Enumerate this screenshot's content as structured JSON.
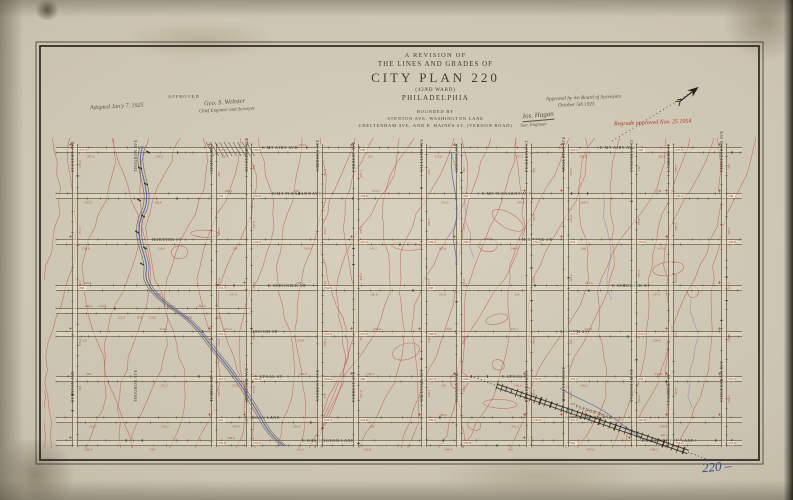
{
  "document": {
    "title": {
      "line1": "A REVISION OF",
      "line2": "THE LINES AND GRADES OF",
      "line3": "CITY PLAN 220",
      "line4": "(42ND WARD)",
      "line5": "PHILADELPHIA",
      "sub1": "BOUNDED BY",
      "sub2": "STENTON AVE. WASHINGTON LANE",
      "sub3": "CHELTENHAM AVE. AND E. HAINES ST. (VERNON ROAD)"
    },
    "annotations": {
      "adopted_note": "Adopted Jan'y 7. 1925",
      "approved_label": "APPROVED",
      "approval_signature": "Geo. S. Webster",
      "approval_title": "Chief Engineer and Surveyor",
      "board_note_line1": "Approved by the Board of Surveyors",
      "board_note_line2": "October 5th 1925",
      "second_signature": "Jos. Hagan",
      "second_signature_title": "Asst. Engineer",
      "regrade_note": "Regrade approved Nov. 25 1954",
      "plan_number_note": "220 –"
    }
  },
  "map": {
    "border": {
      "outer": [
        36,
        42,
        727,
        422
      ],
      "inner": [
        40,
        46,
        719,
        414
      ]
    },
    "grid_extent": {
      "x1": 56,
      "x2": 742,
      "y1": 144,
      "y2": 447
    },
    "horizontal_streets": [
      {
        "y": 150,
        "name": "E MT AIRY AVE",
        "label_xs": [
          262,
          600
        ]
      },
      {
        "y": 196,
        "name": "E MT PLEASANT AVE",
        "label_xs": [
          272,
          482
        ]
      },
      {
        "y": 242,
        "name": "HORTTER ST",
        "label_xs": [
          152,
          522
        ]
      },
      {
        "y": 288,
        "name": "E SEDGWICK ST",
        "label_xs": [
          268,
          612
        ]
      },
      {
        "y": 334,
        "name": "SLOCUM ST",
        "label_xs": [
          250,
          560
        ]
      },
      {
        "y": 379,
        "name": "E UPSAL ST",
        "label_xs": [
          255,
          502
        ]
      },
      {
        "y": 420,
        "name": "GORGAS LANE",
        "label_xs": [
          245,
          565
        ]
      },
      {
        "y": 443,
        "name": "E WASHINGTON LANE",
        "label_xs": [
          302,
          642
        ]
      }
    ],
    "partial_streets": [
      {
        "y": 311,
        "x1": 56,
        "x2": 252
      }
    ],
    "vertical_streets": [
      {
        "x": 75,
        "name": "STENTON AVE"
      },
      {
        "x": 214,
        "name": "TEMPLE RD"
      },
      {
        "x": 249,
        "name": "MICHENER AVE"
      },
      {
        "x": 320,
        "name": "ANDREWS AVE"
      },
      {
        "x": 356,
        "name": "FORREST AVE"
      },
      {
        "x": 424,
        "name": "WILLIAMS AVE"
      },
      {
        "x": 459,
        "name": "OGONTZ AVE"
      },
      {
        "x": 529,
        "name": "PICKERING ST"
      },
      {
        "x": 566,
        "name": "WOOLSTON AVE"
      },
      {
        "x": 634,
        "name": "SYDENHAM ST"
      },
      {
        "x": 671,
        "name": "LAMBERT ST"
      },
      {
        "x": 724,
        "name": "CHELTENHAM AVE"
      }
    ],
    "creek_street": {
      "x": 143,
      "name": "THOURON AVE"
    },
    "diagonal_road": {
      "name": "VERNON ROAD",
      "x1": 497,
      "y1": 386,
      "x2": 688,
      "y2": 452
    },
    "north_line": {
      "x1": 612,
      "y1": 141,
      "x2": 692,
      "y2": 92
    },
    "elevation_samples": [
      "231.5",
      "233.2",
      "234.8",
      "236.4",
      "238",
      "239.6",
      "241.2",
      "242.8",
      "244.4",
      "246",
      "247.6",
      "249.2",
      "250.8",
      "252.4",
      "254",
      "255.6",
      "257.2",
      "258.8",
      "260.4",
      "262"
    ],
    "contour_count": 30,
    "colors": {
      "contour": "#bf5148",
      "contour_alt": "#8a77b5",
      "creek": "#4f5ca8",
      "street": "#6a6152",
      "street_fill": "rgba(230,222,198,0.5)",
      "ink": "#2f2a22",
      "label_ink": "#3c372c",
      "red": "#b03c30",
      "box": "#ece5d2"
    }
  }
}
